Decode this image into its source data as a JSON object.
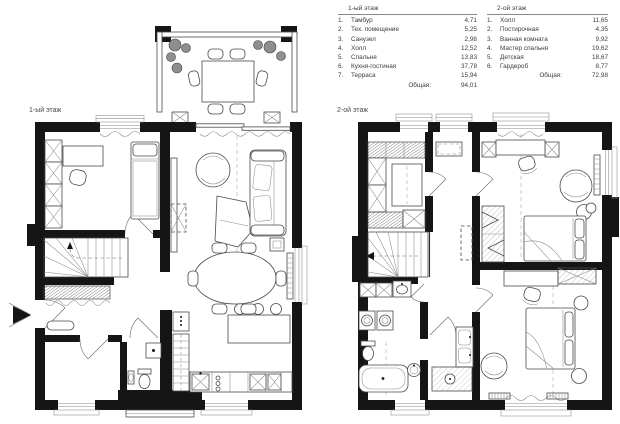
{
  "colors": {
    "wall": "#151515",
    "furniture_line": "#4a4a4a",
    "light_line": "#8a8a8a",
    "text": "#3c3c3c",
    "paper": "#ffffff"
  },
  "floor1": {
    "label": "1-ый этаж",
    "legend": {
      "title": "1-ый этаж",
      "items": [
        {
          "num": "1.",
          "name": "Тамбур",
          "area": "4,71"
        },
        {
          "num": "2.",
          "name": "Тех. помещение",
          "area": "5,25"
        },
        {
          "num": "3.",
          "name": "Санузел",
          "area": "2,98"
        },
        {
          "num": "4.",
          "name": "Холл",
          "area": "12,52"
        },
        {
          "num": "5.",
          "name": "Спальня",
          "area": "13,83"
        },
        {
          "num": "6.",
          "name": "Кухня-гостиная",
          "area": "37,78"
        },
        {
          "num": "7.",
          "name": "Терраса",
          "area": "15,94"
        }
      ],
      "total_label": "Общая:",
      "total_value": "94,01"
    }
  },
  "floor2": {
    "label": "2-ой этаж",
    "legend": {
      "title": "2-ой этаж",
      "items": [
        {
          "num": "1.",
          "name": "Холл",
          "area": "11,65"
        },
        {
          "num": "2.",
          "name": "Постирочная",
          "area": "4,35"
        },
        {
          "num": "3.",
          "name": "Ванная комната",
          "area": "9,92"
        },
        {
          "num": "4.",
          "name": "Мастер спальня",
          "area": "19,62"
        },
        {
          "num": "5.",
          "name": "Детская",
          "area": "18,67"
        },
        {
          "num": "6.",
          "name": "Гардероб",
          "area": "8,77"
        }
      ],
      "total_label": "Общая:",
      "total_value": "72,98"
    }
  }
}
